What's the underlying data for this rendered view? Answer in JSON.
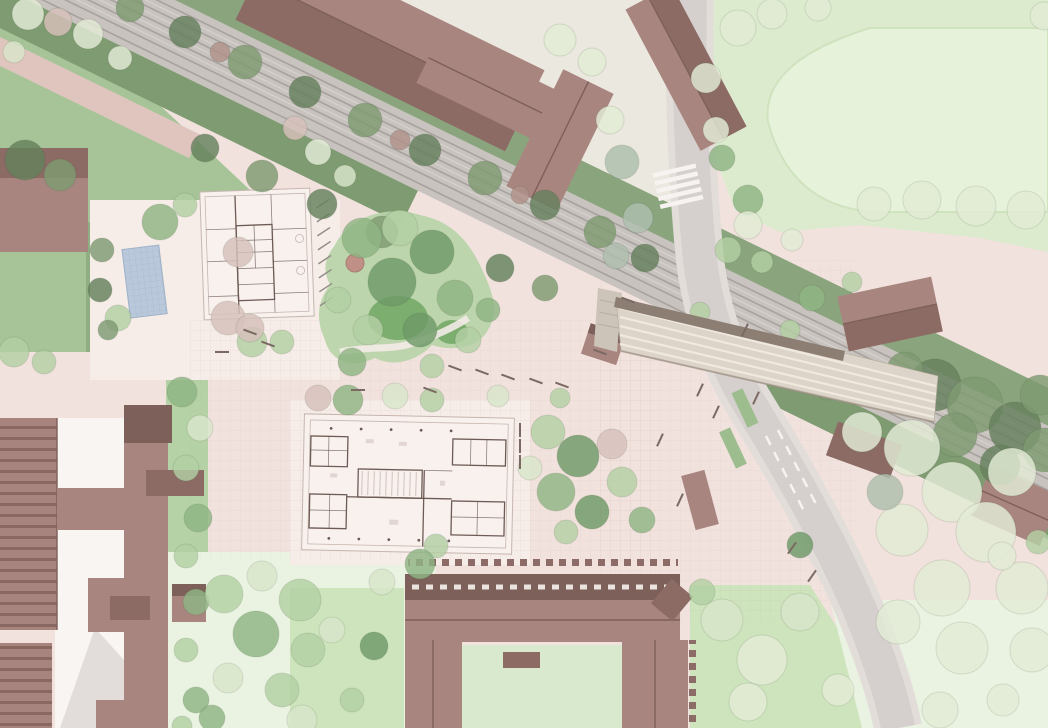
{
  "meta": {
    "title": "Aerial architectural site plan rendering",
    "description": "Masterplan rendering: railway corridor with station canopy, main road, sports field, existing mauve-roofed buildings, two new buildings shown as floor plans, plazas, lawns and trees"
  },
  "palette": {
    "ground": "#f1e2de",
    "apron": "#f6ece8",
    "ne_pale": "#e8ebdf",
    "grass": "#a7c499",
    "grass_dark": "#8fae83",
    "field": "#dcebce",
    "field_inner": "#e6f2da",
    "field_edge": "#cfe3bf",
    "strip": "#b5d2a6",
    "lawn_light": "#eaf2e1",
    "lawn_bright": "#cde4bd",
    "courtyard_lawn": "#d8e9ce",
    "track_bed": "#c8c3bf",
    "rail": "#a7a29e",
    "rail_light": "#d8d4d0",
    "hedge": "#8aa57d",
    "hedge2": "#7f9b72",
    "path_pink": "#e0c5bf",
    "sidewalk": "#e2ddd9",
    "road": "#d5d0cd",
    "road_mark": "#f6f3f0",
    "roof": "#a9857f",
    "roof_dark": "#8c6b65",
    "roof_darker": "#7d6059",
    "plan_fill": "#f8f1ee",
    "plan_wall": "#6e5b55",
    "plan_line": "#c6b6af",
    "canopy": "#dcd4c8",
    "canopy_stripe": "#f0e9df",
    "canopy_edge": "#8c7e73",
    "water": "#b9c8da",
    "mound": "#b9d4a8",
    "mound_dark": "#71a765",
    "busstop": "#9dbd8f",
    "bench": "#7a6a63",
    "tree_g": "#8fb584",
    "tree_d": "#6f9a68",
    "tree_l": "#b3d0a4",
    "tree_p": "#d9e6cb",
    "tree_s": "#e3ecd6",
    "tree_k": "#d7c1bb",
    "tree_y": "#aebfae",
    "tree_h": "#7f9b72",
    "tree_hd": "#66815d",
    "tree_b": "#b0928a"
  },
  "features": [
    "railway-corridor",
    "station-canopy",
    "station-platform",
    "main-road",
    "pedestrian-crossing",
    "sports-field",
    "playground-mound",
    "water-feature",
    "new-building-floor-plan-north",
    "new-building-floor-plan-central",
    "existing-school-complex",
    "courtyard-building",
    "station-building",
    "bus-stop-islands",
    "tree-lined-plaza"
  ],
  "trees": [
    [
      28,
      14,
      16,
      "s"
    ],
    [
      58,
      22,
      14,
      "k"
    ],
    [
      88,
      34,
      15,
      "s"
    ],
    [
      14,
      52,
      11,
      "p"
    ],
    [
      120,
      58,
      12,
      "s"
    ],
    [
      130,
      8,
      14,
      "h"
    ],
    [
      185,
      32,
      16,
      "hd"
    ],
    [
      245,
      62,
      17,
      "h"
    ],
    [
      305,
      92,
      16,
      "hd"
    ],
    [
      365,
      120,
      17,
      "h"
    ],
    [
      425,
      150,
      16,
      "hd"
    ],
    [
      485,
      178,
      17,
      "h"
    ],
    [
      545,
      205,
      15,
      "hd"
    ],
    [
      600,
      232,
      16,
      "h"
    ],
    [
      645,
      258,
      14,
      "hd"
    ],
    [
      220,
      52,
      10,
      "b"
    ],
    [
      400,
      140,
      10,
      "b"
    ],
    [
      520,
      195,
      9,
      "b"
    ],
    [
      205,
      148,
      14,
      "hd"
    ],
    [
      262,
      176,
      16,
      "h"
    ],
    [
      322,
      204,
      15,
      "hd"
    ],
    [
      382,
      232,
      16,
      "h"
    ],
    [
      500,
      268,
      14,
      "hd"
    ],
    [
      545,
      288,
      13,
      "h"
    ],
    [
      935,
      385,
      26,
      "hd"
    ],
    [
      975,
      405,
      28,
      "h"
    ],
    [
      1015,
      428,
      26,
      "hd"
    ],
    [
      1045,
      450,
      22,
      "h"
    ],
    [
      955,
      435,
      22,
      "h"
    ],
    [
      1000,
      465,
      20,
      "hd"
    ],
    [
      1040,
      395,
      20,
      "h"
    ],
    [
      905,
      370,
      18,
      "h"
    ],
    [
      826,
      390,
      10,
      "h"
    ],
    [
      25,
      160,
      20,
      "hd"
    ],
    [
      60,
      175,
      16,
      "h"
    ],
    [
      160,
      222,
      18,
      "g"
    ],
    [
      185,
      205,
      12,
      "l"
    ],
    [
      238,
      252,
      15,
      "k"
    ],
    [
      118,
      318,
      13,
      "l"
    ],
    [
      228,
      318,
      17,
      "k"
    ],
    [
      252,
      342,
      15,
      "l"
    ],
    [
      102,
      250,
      12,
      "h"
    ],
    [
      100,
      290,
      12,
      "hd"
    ],
    [
      108,
      330,
      10,
      "h"
    ],
    [
      14,
      352,
      15,
      "l"
    ],
    [
      44,
      362,
      12,
      "l"
    ],
    [
      295,
      128,
      12,
      "k"
    ],
    [
      318,
      152,
      13,
      "s"
    ],
    [
      345,
      176,
      11,
      "p"
    ],
    [
      362,
      238,
      20,
      "g"
    ],
    [
      400,
      228,
      18,
      "l"
    ],
    [
      432,
      252,
      22,
      "d"
    ],
    [
      392,
      282,
      24,
      "d"
    ],
    [
      455,
      298,
      18,
      "g"
    ],
    [
      420,
      330,
      17,
      "d"
    ],
    [
      368,
      330,
      15,
      "l"
    ],
    [
      338,
      300,
      13,
      "l"
    ],
    [
      352,
      362,
      14,
      "g"
    ],
    [
      432,
      366,
      12,
      "l"
    ],
    [
      468,
      340,
      13,
      "l"
    ],
    [
      488,
      310,
      12,
      "g"
    ],
    [
      250,
      328,
      14,
      "k"
    ],
    [
      282,
      342,
      12,
      "l"
    ],
    [
      182,
      392,
      15,
      "g"
    ],
    [
      200,
      428,
      13,
      "p"
    ],
    [
      186,
      468,
      13,
      "l"
    ],
    [
      198,
      518,
      14,
      "g"
    ],
    [
      186,
      556,
      12,
      "l"
    ],
    [
      196,
      602,
      13,
      "g"
    ],
    [
      186,
      650,
      12,
      "l"
    ],
    [
      196,
      700,
      13,
      "g"
    ],
    [
      182,
      726,
      10,
      "l"
    ],
    [
      318,
      398,
      13,
      "k"
    ],
    [
      348,
      400,
      15,
      "g"
    ],
    [
      395,
      396,
      13,
      "p"
    ],
    [
      432,
      400,
      12,
      "l"
    ],
    [
      498,
      396,
      11,
      "p"
    ],
    [
      560,
      398,
      10,
      "l"
    ],
    [
      548,
      432,
      17,
      "l"
    ],
    [
      578,
      456,
      21,
      "d"
    ],
    [
      612,
      444,
      15,
      "k"
    ],
    [
      556,
      492,
      19,
      "g"
    ],
    [
      592,
      512,
      17,
      "d"
    ],
    [
      622,
      482,
      15,
      "l"
    ],
    [
      642,
      520,
      13,
      "g"
    ],
    [
      566,
      532,
      12,
      "l"
    ],
    [
      530,
      468,
      12,
      "p"
    ],
    [
      436,
      546,
      12,
      "l"
    ],
    [
      642,
      330,
      15,
      "g"
    ],
    [
      672,
      346,
      12,
      "l"
    ],
    [
      700,
      312,
      10,
      "l"
    ],
    [
      622,
      162,
      17,
      "y"
    ],
    [
      638,
      218,
      15,
      "y"
    ],
    [
      616,
      256,
      13,
      "y"
    ],
    [
      722,
      158,
      13,
      "g"
    ],
    [
      748,
      200,
      15,
      "g"
    ],
    [
      728,
      250,
      13,
      "l"
    ],
    [
      762,
      262,
      11,
      "l"
    ],
    [
      812,
      298,
      13,
      "g"
    ],
    [
      790,
      330,
      10,
      "l"
    ],
    [
      852,
      282,
      10,
      "l"
    ],
    [
      224,
      594,
      19,
      "l"
    ],
    [
      262,
      576,
      15,
      "p"
    ],
    [
      300,
      600,
      21,
      "l"
    ],
    [
      256,
      634,
      23,
      "g"
    ],
    [
      308,
      650,
      17,
      "l"
    ],
    [
      228,
      678,
      15,
      "p"
    ],
    [
      282,
      690,
      17,
      "l"
    ],
    [
      332,
      630,
      13,
      "p"
    ],
    [
      352,
      700,
      12,
      "l"
    ],
    [
      212,
      718,
      13,
      "g"
    ],
    [
      382,
      582,
      13,
      "p"
    ],
    [
      302,
      720,
      15,
      "p"
    ],
    [
      420,
      564,
      15,
      "g"
    ],
    [
      374,
      646,
      14,
      "d"
    ],
    [
      722,
      620,
      21,
      "p"
    ],
    [
      762,
      660,
      25,
      "s"
    ],
    [
      800,
      612,
      19,
      "p"
    ],
    [
      748,
      702,
      19,
      "s"
    ],
    [
      702,
      592,
      13,
      "l"
    ],
    [
      800,
      545,
      13,
      "d"
    ],
    [
      838,
      690,
      16,
      "s"
    ],
    [
      862,
      432,
      20,
      "s"
    ],
    [
      912,
      448,
      28,
      "s"
    ],
    [
      952,
      492,
      30,
      "s"
    ],
    [
      902,
      530,
      26,
      "s"
    ],
    [
      986,
      532,
      30,
      "s"
    ],
    [
      942,
      588,
      28,
      "s"
    ],
    [
      1012,
      472,
      24,
      "s"
    ],
    [
      898,
      622,
      22,
      "s"
    ],
    [
      962,
      648,
      26,
      "s"
    ],
    [
      1022,
      588,
      26,
      "s"
    ],
    [
      1032,
      650,
      22,
      "s"
    ],
    [
      885,
      492,
      18,
      "y"
    ],
    [
      1003,
      700,
      16,
      "s"
    ],
    [
      940,
      710,
      18,
      "s"
    ],
    [
      738,
      28,
      18,
      "s"
    ],
    [
      772,
      14,
      15,
      "s"
    ],
    [
      818,
      8,
      13,
      "s"
    ],
    [
      706,
      78,
      15,
      "s"
    ],
    [
      716,
      130,
      13,
      "s"
    ],
    [
      748,
      225,
      14,
      "s"
    ],
    [
      792,
      240,
      11,
      "s"
    ],
    [
      874,
      204,
      17,
      "s"
    ],
    [
      922,
      200,
      19,
      "s"
    ],
    [
      976,
      206,
      20,
      "s"
    ],
    [
      1026,
      210,
      19,
      "s"
    ],
    [
      1044,
      16,
      14,
      "s"
    ],
    [
      1002,
      556,
      14,
      "s"
    ],
    [
      1038,
      542,
      12,
      "l"
    ],
    [
      560,
      40,
      16,
      "s"
    ],
    [
      610,
      120,
      14,
      "s"
    ],
    [
      592,
      62,
      14,
      "s"
    ]
  ],
  "benches": [
    [
      250,
      332,
      20
    ],
    [
      268,
      344,
      20
    ],
    [
      222,
      352,
      0
    ],
    [
      455,
      368,
      20
    ],
    [
      482,
      372,
      20
    ],
    [
      508,
      377,
      20
    ],
    [
      536,
      381,
      20
    ],
    [
      562,
      385,
      20
    ],
    [
      430,
      390,
      20
    ],
    [
      600,
      352,
      20
    ],
    [
      628,
      300,
      20
    ],
    [
      700,
      390,
      -65
    ],
    [
      716,
      412,
      -65
    ],
    [
      756,
      398,
      -65
    ],
    [
      358,
      390,
      0
    ],
    [
      520,
      430,
      90
    ],
    [
      520,
      446,
      90
    ],
    [
      520,
      462,
      90
    ],
    [
      745,
      330,
      -65
    ],
    [
      792,
      548,
      -55
    ],
    [
      812,
      576,
      -55
    ],
    [
      660,
      440,
      -65
    ],
    [
      680,
      500,
      -65
    ]
  ]
}
